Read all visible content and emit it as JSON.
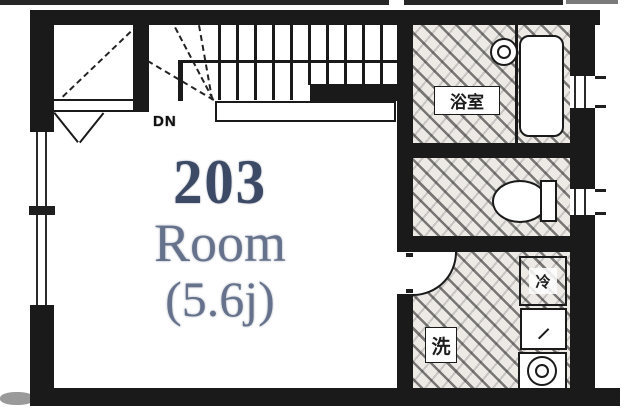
{
  "plan": {
    "room_number": "203",
    "room_name": "Room",
    "room_area": "(5.6j)",
    "stairs_label": "DN",
    "bathroom_label": "浴室",
    "washstand_label": "洗",
    "fridge_label": "冷"
  },
  "colors": {
    "wall": "#1a1a1a",
    "number": "#3d4a66",
    "roomtext": "#66728b",
    "labeltext": "#1c1c1c",
    "strip": "#262626",
    "texbg": "#edeae6",
    "blob": "#9a9a9a"
  }
}
